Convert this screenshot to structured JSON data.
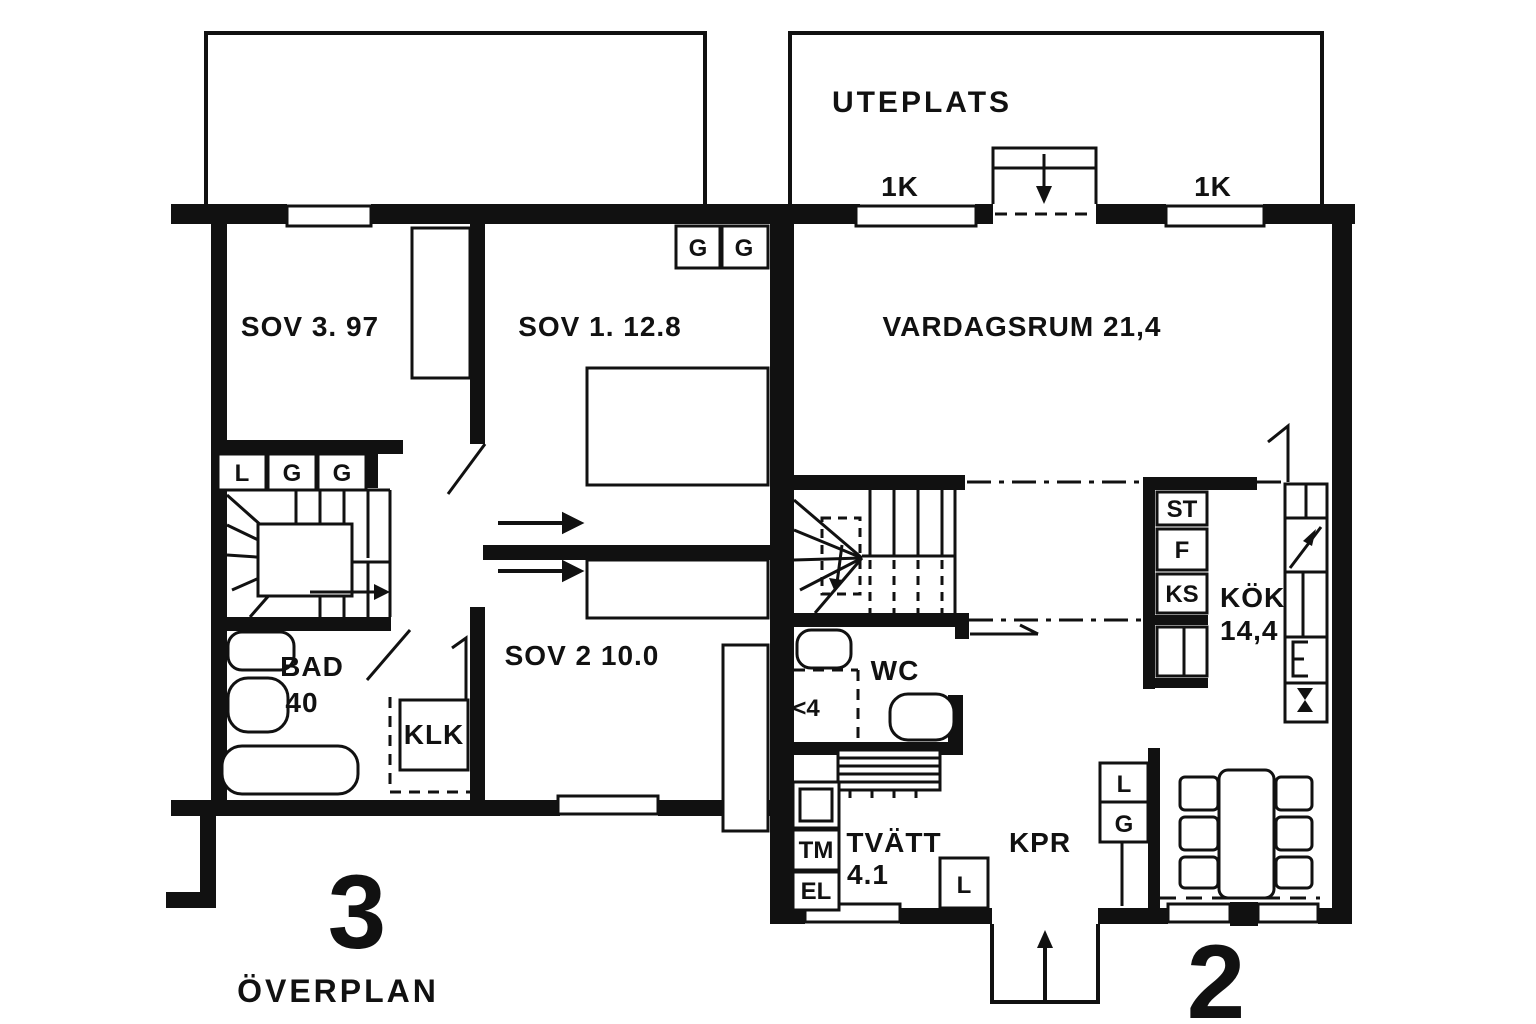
{
  "plan": {
    "paper_color": "#ffffff",
    "ink_color": "#111111",
    "unit_left": {
      "number": "3",
      "floor_label": "ÖVERPLAN",
      "rooms": {
        "sov3": "SOV 3. 97",
        "sov1": "SOV 1. 12.8",
        "sov2": "SOV 2 10.0",
        "bad": "BAD",
        "bad_area": "40",
        "klk": "KLK"
      },
      "closet_row": [
        "L",
        "G",
        "G"
      ],
      "wardrobes": [
        "G",
        "G"
      ]
    },
    "unit_right": {
      "number": "2",
      "terrace": "UTEPLATS",
      "windows": [
        "1K",
        "1K"
      ],
      "rooms": {
        "vardagsrum": "VARDAGSRUM 21,4",
        "wc": "WC",
        "wc_marker": "<4",
        "kok": "KÖK",
        "kok_area": "14,4",
        "tvatt": "TVÄTT",
        "tvatt_area": "4.1",
        "kpr": "KPR"
      },
      "kitchen_units": [
        "ST",
        "F",
        "KS"
      ],
      "laundry_units": [
        "TM",
        "EL"
      ],
      "closets": {
        "hall_l": "L",
        "kpr_l": "L",
        "kpr_g": "G"
      }
    }
  }
}
